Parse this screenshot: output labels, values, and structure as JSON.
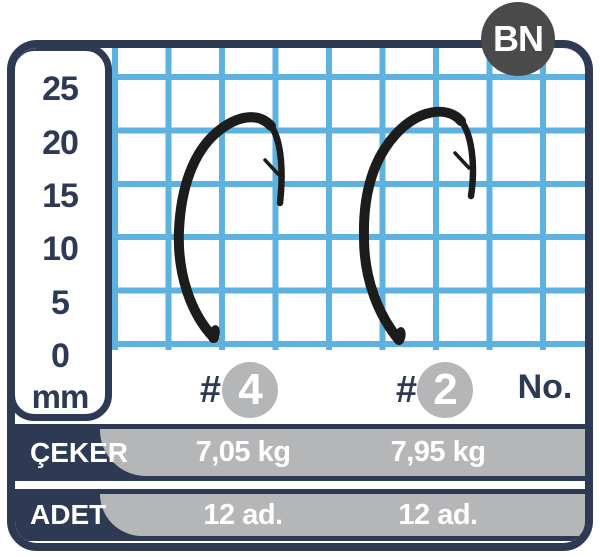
{
  "badge": {
    "label": "BN"
  },
  "ruler": {
    "unit": "mm",
    "labels": [
      "25",
      "20",
      "15",
      "10",
      "5",
      "0",
      "mm"
    ]
  },
  "columns": {
    "unit_label": "No.",
    "items": [
      {
        "hash": "#",
        "size": "4"
      },
      {
        "hash": "#",
        "size": "2"
      }
    ]
  },
  "specs": {
    "rows": [
      {
        "label": "ÇEKER",
        "values": [
          "7,05 kg",
          "7,95 kg"
        ]
      },
      {
        "label": "ADET",
        "values": [
          "12 ad.",
          "12 ad."
        ]
      }
    ]
  },
  "colors": {
    "navy": "#2e3a53",
    "grid_blue": "#5eb2e2",
    "bar_gray": "#b5b6b8",
    "bn_badge_gray": "#4a4a4b",
    "hook_black": "#1c1c1c"
  }
}
